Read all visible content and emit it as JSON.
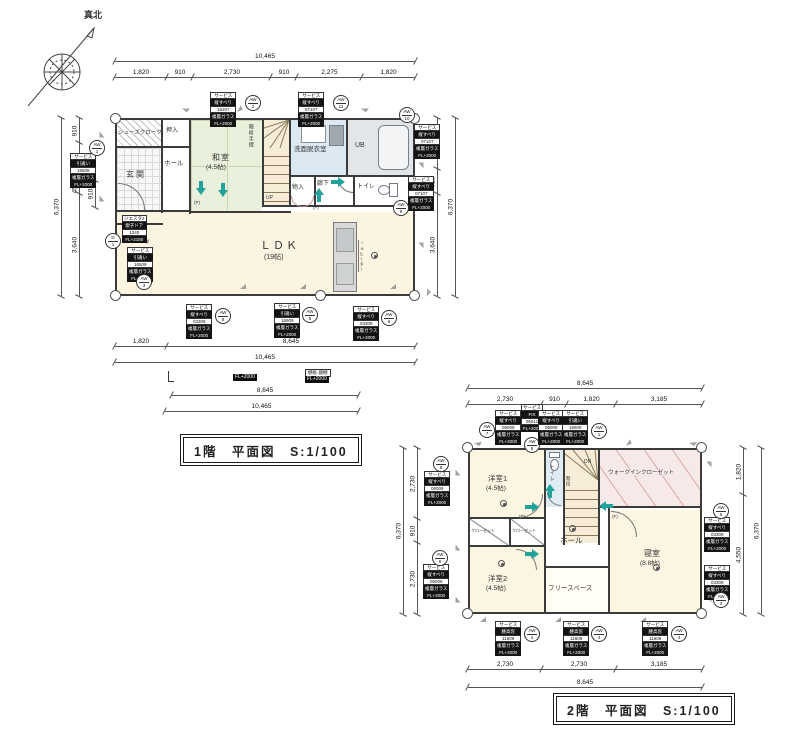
{
  "compass": {
    "north_label": "真北"
  },
  "floor1": {
    "title": "1階　平面図　S:1/100",
    "rooms": {
      "shoes": "シューズクローク",
      "oshiire": "押入",
      "genkan": "玄関",
      "hall": "ホール",
      "washitsu": "和室",
      "washitsu_size": "(4.5帖)",
      "handrail": "階段手摺",
      "up": "UP",
      "mono": "物入",
      "rouka": "廊下",
      "senmen": "洗面脱衣室",
      "ub": "UB",
      "toilet": "トイレ",
      "ldk": "ＬＤＫ",
      "ldk_size": "(19帖)",
      "ih": "IHヒーター",
      "marker_f": "(F)",
      "marker_p": "(P)"
    },
    "dims": {
      "top_total": "10,465",
      "top_segs": [
        "1,820",
        "910",
        "2,730",
        "910",
        "2,275",
        "1,820"
      ],
      "left_total": "6,370",
      "left_segs": [
        "910",
        "1,365",
        "455",
        "3,640"
      ],
      "left_inner": "910",
      "right_total": "6,370",
      "right_segs": [
        "1,820",
        "910",
        "3,640"
      ],
      "bottom_segs": [
        "1,820",
        "8,645"
      ],
      "bottom_total": "10,465",
      "sub_dim_8645": "8,645",
      "sub_dim_10465": "10,465"
    },
    "sub_labels": {
      "fl2000": "FL+2000",
      "tana": "棚板·鏡棚",
      "tana_fl": "FL+2000"
    }
  },
  "floor2": {
    "title": "2階　平面図　S:1/100",
    "rooms": {
      "yoshitsu1": "洋室1",
      "yoshitsu1_size": "(4.5帖)",
      "toilet": "トイレ",
      "stairs": "階段",
      "dn": "DN",
      "wic": "ウォークインクローゼット",
      "hall": "ホール",
      "closet1": "クローゼット",
      "closet2": "クローゼット",
      "yoshitsu2": "洋室2",
      "yoshitsu2_size": "(4.5帖)",
      "free": "フリースペース",
      "bedroom": "寝室",
      "bedroom_size": "(8.8帖)",
      "marker_p": "(P)",
      "marker_f": "(F)"
    },
    "dims": {
      "top_total": "8,645",
      "top_segs": [
        "2,730",
        "910",
        "1,820",
        "3,185"
      ],
      "left_total": "6,370",
      "left_segs": [
        "2,730",
        "910",
        "2,730"
      ],
      "right_total": "6,370",
      "right_segs": [
        "1,820",
        "4,550"
      ],
      "bottom_segs": [
        "2,730",
        "2,730",
        "3,185"
      ],
      "bottom_total": "8,645"
    }
  },
  "window_labels": [
    {
      "badge": [
        "AW",
        "1"
      ],
      "lines": [
        "サービス",
        "引違い",
        "16509",
        "複層ガラス",
        "FL+2000"
      ]
    },
    {
      "badge": [
        "AW",
        "2"
      ],
      "lines": [
        "サービス",
        "縦すべり",
        "16207",
        "複層ガラス",
        "FL+2000"
      ]
    },
    {
      "badge": [
        "AW",
        "11"
      ],
      "lines": [
        "サービス",
        "縦すべり",
        "07107",
        "複層ガラス",
        "FL+2000"
      ]
    },
    {
      "badge": [
        "AW",
        "10"
      ],
      "lines": [
        "サービス",
        "縦すべり",
        "07107",
        "複層ガラス",
        "FL+2000"
      ]
    },
    {
      "badge": [
        "AW",
        "9"
      ],
      "lines": [
        "サービス",
        "縦すべり",
        "07107",
        "複層ガラス",
        "FL+2000"
      ]
    },
    {
      "badge": [
        "D",
        "1"
      ],
      "lines": [
        "ジエスタ2",
        "親子ドア",
        "1240",
        "FL+2180"
      ]
    },
    {
      "badge": [
        "AW",
        "3"
      ],
      "lines": [
        "サービス",
        "引違い",
        "16509",
        "複層ガラス",
        "FL+2000"
      ]
    },
    {
      "badge": [
        "AW",
        "8"
      ],
      "lines": [
        "サービス",
        "縦すべり",
        "03309",
        "複層ガラス",
        "FL+2000"
      ]
    },
    {
      "badge": [
        "AW",
        "5"
      ],
      "lines": [
        "サービス",
        "引違い",
        "16909",
        "複層ガラス",
        "FL+2000"
      ]
    },
    {
      "badge": [
        "AW",
        "6"
      ],
      "lines": [
        "サービス",
        "縦すべり",
        "03309",
        "複層ガラス",
        "FL+2000"
      ]
    },
    {
      "badge": [
        "AW",
        "7"
      ],
      "lines": [
        "サービス",
        "縦すべり",
        "06009",
        "複層ガラス",
        "FL+2000"
      ]
    },
    {
      "badge": [
        "AW",
        "9"
      ],
      "lines": [
        "サービス",
        "FIX",
        "06011",
        "FL+2000"
      ]
    },
    {
      "badge": null,
      "lines": [
        "サービス",
        "縦すべり",
        "06009",
        "複層ガラス",
        "FL+2000"
      ]
    },
    {
      "badge": [
        "AW",
        "1"
      ],
      "lines": [
        "サービス",
        "引違い",
        "16609",
        "複層ガラス",
        "FL+2000"
      ]
    },
    {
      "badge": [
        "AW",
        "8"
      ],
      "lines": [
        "サービス",
        "縦すべり",
        "06009",
        "複層ガラス",
        "FL+2000"
      ]
    },
    {
      "badge": [
        "AW",
        "6"
      ],
      "lines": [
        "サービス",
        "縦すべり",
        "06009",
        "複層ガラス",
        "FL+2000"
      ]
    },
    {
      "badge": [
        "AW",
        "5"
      ],
      "lines": [
        "サービス",
        "縦すべり",
        "03309",
        "複層ガラス",
        "FL+2000"
      ]
    },
    {
      "badge": [
        "AW",
        "3"
      ],
      "lines": [
        "サービス",
        "縦すべり",
        "03309",
        "複層ガラス",
        "FL+2000"
      ]
    },
    {
      "badge": [
        "AW",
        "4"
      ],
      "lines": [
        "サービス",
        "腰高窓",
        "11609",
        "複層ガラス",
        "FL+2000"
      ]
    },
    {
      "badge": [
        "AW",
        "4"
      ],
      "lines": [
        "サービス",
        "腰高窓",
        "11609",
        "複層ガラス",
        "FL+2000"
      ]
    },
    {
      "badge": [
        "AW",
        "4"
      ],
      "lines": [
        "サービス",
        "腰高窓",
        "11609",
        "複層ガラス",
        "FL+2000"
      ]
    }
  ]
}
